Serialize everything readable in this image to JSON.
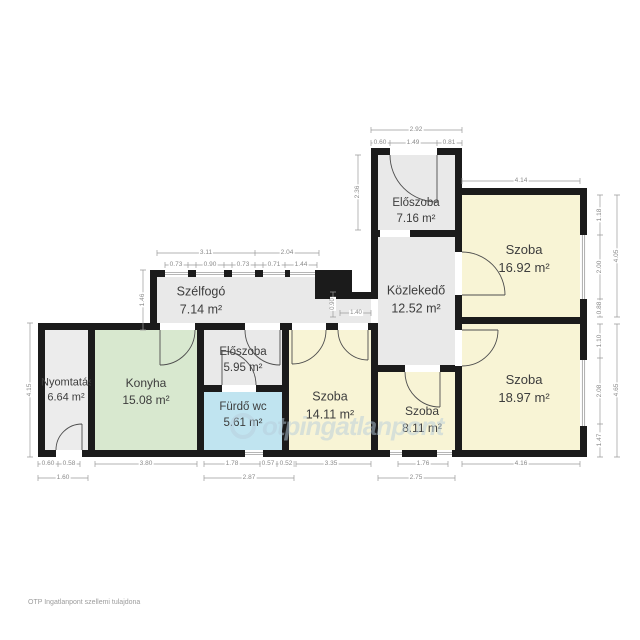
{
  "document": {
    "type": "apartment floor plan",
    "footer": "OTP Ingatlanpont szellemi tulajdona",
    "watermark": "otpingatlanpont"
  },
  "colors": {
    "wall": "#1b1b1b",
    "room_gray": "#e9e9e9",
    "kitchen_green": "#d8e8cf",
    "bath_blue": "#c0e4f0",
    "room_yellow": "#f8f4d5",
    "dimension_gray": "#8a8a8a",
    "label_text": "#3d3d3d"
  },
  "rooms": [
    {
      "name": "Nyomtatás",
      "area": "6.64 m²"
    },
    {
      "name": "Konyha",
      "area": "15.08 m²"
    },
    {
      "name": "Szélfogó",
      "area": "7.14 m²"
    },
    {
      "name": "Előszoba",
      "area": "5.95 m²"
    },
    {
      "name": "Fürdő wc",
      "area": "5.61 m²"
    },
    {
      "name": "Szoba",
      "area": "14.11 m²"
    },
    {
      "name": "Szoba",
      "area": "8.11 m²"
    },
    {
      "name": "Előszoba",
      "area": "7.16 m²"
    },
    {
      "name": "Közlekedő",
      "area": "12.52 m²"
    },
    {
      "name": "Szoba",
      "area": "16.92 m²"
    },
    {
      "name": "Szoba",
      "area": "18.97 m²"
    }
  ],
  "dims": {
    "top_total": "2.92",
    "top_seg1": "0.60",
    "top_seg2": "1.49",
    "top_seg3": "0.81",
    "eloszoba1_left": "2.36",
    "szoba16_top": "4.14",
    "szoba16_right_seg1": "1.18",
    "szoba16_right_seg2": "2.00",
    "szoba16_right_seg3": "0.88",
    "szoba16_right_total": "4.05",
    "szoba18_right_seg1": "1.10",
    "szoba18_right_seg2": "2.08",
    "szoba18_right_seg3": "1.47",
    "szoba18_right_total": "4.65",
    "szelfogo_total1": "3.11",
    "szelfogo_total2": "2.04",
    "szelfogo_seg1": "0.73",
    "szelfogo_seg2": "0.90",
    "szelfogo_seg3": "0.73",
    "szelfogo_seg4": "0.71",
    "szelfogo_seg5": "1.44",
    "szelfogo_left": "1.46",
    "plan_left": "4.15",
    "corridor_h": "0.90",
    "corridor_w": "1.40",
    "bottom_nyom_seg1": "0.60",
    "bottom_nyom_seg2": "0.58",
    "bottom_nyom_total": "1.60",
    "bottom_konyha": "3.80",
    "bottom_furdo_seg1": "1.78",
    "bottom_furdo_seg2": "0.57",
    "bottom_furdo_seg3": "0.52",
    "bottom_furdo_total": "2.87",
    "bottom_szoba14": "3.35",
    "bottom_szoba8_seg": "1.76",
    "bottom_szoba8_total": "2.75",
    "bottom_szoba18": "4.16"
  }
}
